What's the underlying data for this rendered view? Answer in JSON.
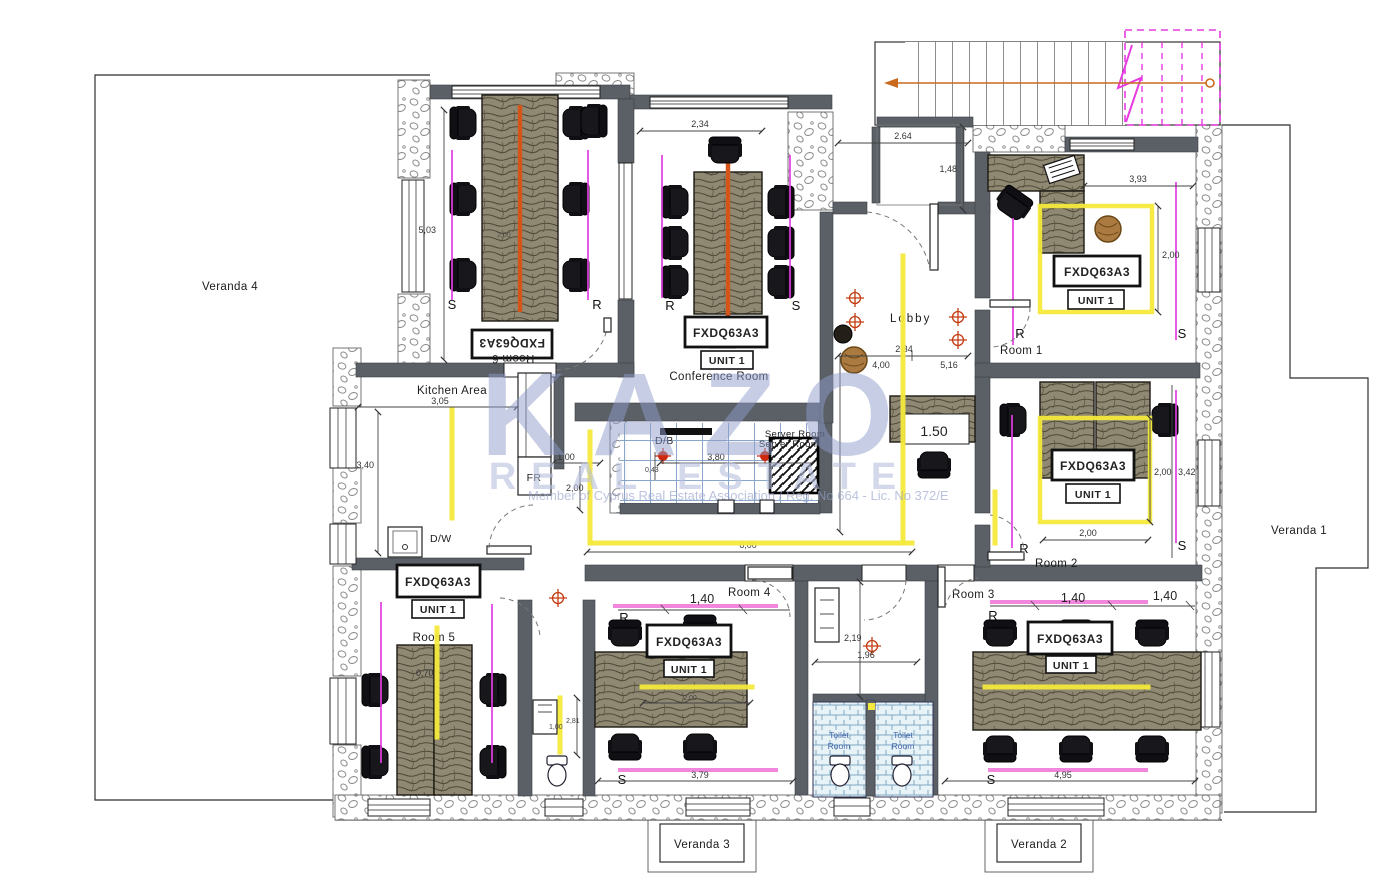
{
  "watermark": {
    "brand": "KAZO",
    "tagline": "REAL ESTATE",
    "note": "Member of Cyprus Real Estate Association /  Reg. No 664 - Lic. No 372/E"
  },
  "verandas": {
    "v1": "Veranda 1",
    "v2": "Veranda 2",
    "v3": "Veranda 3",
    "v4": "Veranda 4"
  },
  "rooms": {
    "room1": "Room 1",
    "room2": "Room 2",
    "room3": "Room 3",
    "room4": "Room 4",
    "room5": "Room 5",
    "room6": "Room 6",
    "conference": "Conference Room",
    "lobby": "Lobby",
    "kitchen": "Kitchen Area",
    "server": "Server Room",
    "db": "D/B",
    "fr": "FR",
    "dw": "D/W",
    "toilet_line1": "Toilet",
    "toilet_line2": "Room"
  },
  "unit": {
    "model": "FXDQ63A3",
    "name": "UNIT 1"
  },
  "letters": {
    "s": "S",
    "r": "R"
  },
  "dims": {
    "conf_w": "2,34",
    "stairs_w": "2.64",
    "stairs_h": "1,48",
    "r1_w": "3,93",
    "r1_h": "2,00",
    "r6_h": "5,03",
    "r6_t": "2,00",
    "lobby_a": "2,34",
    "lobby_h": "4,00",
    "lobby_w": "5,16",
    "reception": "1.50",
    "kit_w": "3,05",
    "kit_h": "3,40",
    "db_a": "1,00",
    "db_b": "2,00",
    "db_c": "0,43",
    "db_w": "3,80",
    "hall_w": "6,00",
    "r5_t": "0,70",
    "wc5_a": "1,00",
    "wc5_b": "2,81",
    "r4_t": "1,40",
    "r4_tw": "2,00",
    "r4_w": "3,79",
    "wc_h": "2,19",
    "wc_w": "1,96",
    "r3_t1": "1,40",
    "r3_t2": "1,40",
    "r3_w": "4,95",
    "r2_h": "2,00",
    "r2_hh": "3,42",
    "r2_w": "2,00"
  }
}
